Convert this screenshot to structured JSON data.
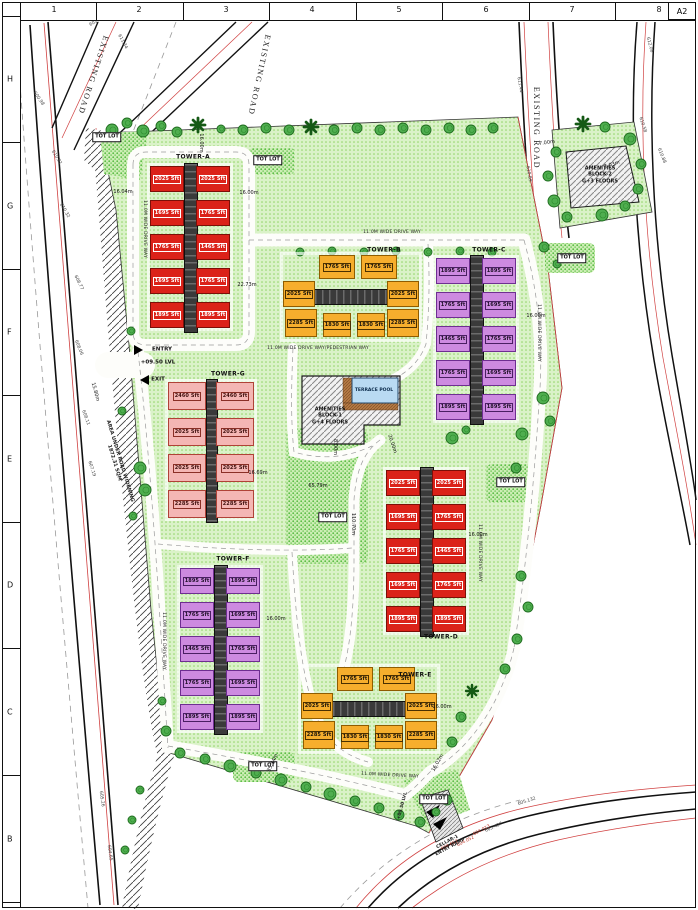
{
  "frame": {
    "sheet": "A2",
    "top_numbers": [
      {
        "t": "1",
        "x": 52
      },
      {
        "t": "2",
        "x": 137
      },
      {
        "t": "3",
        "x": 224
      },
      {
        "t": "4",
        "x": 310
      },
      {
        "t": "5",
        "x": 397
      },
      {
        "t": "6",
        "x": 484
      },
      {
        "t": "7",
        "x": 570
      },
      {
        "t": "8",
        "x": 657
      }
    ],
    "left_letters": [
      {
        "t": "H",
        "y": 77
      },
      {
        "t": "G",
        "y": 204
      },
      {
        "t": "F",
        "y": 330
      },
      {
        "t": "E",
        "y": 457
      },
      {
        "t": "D",
        "y": 583
      },
      {
        "t": "C",
        "y": 710
      },
      {
        "t": "B",
        "y": 837
      }
    ],
    "top_ticks": [
      8,
      94,
      181,
      267,
      354,
      440,
      527,
      613,
      668
    ],
    "left_ticks": [
      14,
      140,
      267,
      393,
      520,
      646,
      773,
      900
    ]
  },
  "palette": {
    "red": {
      "bg": "#db2219",
      "bd": "#7c0f08",
      "tx": "#ffffff",
      "lb": "#ffffff"
    },
    "orange": {
      "bg": "#f6ae2d",
      "bd": "#8f5c00",
      "tx": "#18120a",
      "lb": "#4a3000"
    },
    "purple": {
      "bg": "#cd8ae0",
      "bd": "#6e2e91",
      "tx": "#1d1026",
      "lb": "#4a1f63"
    },
    "pink": {
      "bg": "#f4b6b4",
      "bd": "#b04237",
      "tx": "#3d0f0c",
      "lb": "#8a2f26"
    },
    "lawn": "#daf2c8",
    "lawn_dot": "#8fd465",
    "dense": "#cdeeb5",
    "dense_dot": "#57bb42",
    "pool": "#b9daf2",
    "deck": "#b57a45",
    "road_red": "#d04040",
    "core": "#3a3a3a"
  },
  "towers": [
    {
      "name": "TOWER-A",
      "nx": 193,
      "ny": 157,
      "color": "red",
      "x": 150,
      "y": 166,
      "w": 80,
      "h": 162,
      "uw": 34,
      "uh": 26,
      "core": {
        "x": 34,
        "y": -3,
        "w": 12,
        "h": 168,
        "dir": "v"
      },
      "units": [
        {
          "x": 0,
          "y": 0,
          "t": "2025 Sft"
        },
        {
          "x": 46,
          "y": 0,
          "t": "2025 Sft"
        },
        {
          "x": 0,
          "y": 34,
          "t": "1695 Sft"
        },
        {
          "x": 46,
          "y": 34,
          "t": "1765 Sft"
        },
        {
          "x": 0,
          "y": 68,
          "t": "1765 Sft"
        },
        {
          "x": 46,
          "y": 68,
          "t": "1465 Sft"
        },
        {
          "x": 0,
          "y": 102,
          "t": "1695 Sft"
        },
        {
          "x": 46,
          "y": 102,
          "t": "1765 Sft"
        },
        {
          "x": 0,
          "y": 136,
          "t": "1895 Sft"
        },
        {
          "x": 46,
          "y": 136,
          "t": "1895 Sft"
        }
      ]
    },
    {
      "name": "TOWER-B",
      "nx": 384,
      "ny": 250,
      "color": "orange",
      "x": 283,
      "y": 255,
      "w": 136,
      "h": 84,
      "core": {
        "x": 10,
        "y": 34,
        "w": 118,
        "h": 14,
        "dir": "h"
      },
      "units": [
        {
          "x": 36,
          "y": 0,
          "w": 36,
          "h": 24,
          "t": "1765 Sft"
        },
        {
          "x": 78,
          "y": 0,
          "w": 36,
          "h": 24,
          "t": "1765 Sft"
        },
        {
          "x": 0,
          "y": 26,
          "w": 32,
          "h": 26,
          "t": "2025 Sft"
        },
        {
          "x": 104,
          "y": 26,
          "w": 32,
          "h": 26,
          "t": "2025 Sft"
        },
        {
          "x": 2,
          "y": 54,
          "w": 32,
          "h": 28,
          "t": "2285 Sft"
        },
        {
          "x": 40,
          "y": 58,
          "w": 28,
          "h": 24,
          "t": "1830 Sft"
        },
        {
          "x": 74,
          "y": 58,
          "w": 28,
          "h": 24,
          "t": "1830 Sft"
        },
        {
          "x": 104,
          "y": 54,
          "w": 32,
          "h": 28,
          "t": "2285 Sft"
        }
      ]
    },
    {
      "name": "TOWER-C",
      "nx": 489,
      "ny": 250,
      "color": "purple",
      "x": 436,
      "y": 258,
      "w": 80,
      "h": 162,
      "uw": 34,
      "uh": 26,
      "core": {
        "x": 34,
        "y": -3,
        "w": 12,
        "h": 168,
        "dir": "v"
      },
      "units": [
        {
          "x": 0,
          "y": 0,
          "t": "1895 Sft"
        },
        {
          "x": 46,
          "y": 0,
          "t": "1895 Sft"
        },
        {
          "x": 0,
          "y": 34,
          "t": "1765 Sft"
        },
        {
          "x": 46,
          "y": 34,
          "t": "1695 Sft"
        },
        {
          "x": 0,
          "y": 68,
          "t": "1465 Sft"
        },
        {
          "x": 46,
          "y": 68,
          "t": "1765 Sft"
        },
        {
          "x": 0,
          "y": 102,
          "t": "1765 Sft"
        },
        {
          "x": 46,
          "y": 102,
          "t": "1695 Sft"
        },
        {
          "x": 0,
          "y": 136,
          "t": "1895 Sft"
        },
        {
          "x": 46,
          "y": 136,
          "t": "1895 Sft"
        }
      ]
    },
    {
      "name": "TOWER-G",
      "nx": 228,
      "ny": 374,
      "color": "pink",
      "x": 168,
      "y": 382,
      "w": 86,
      "h": 136,
      "uw": 38,
      "uh": 28,
      "core": {
        "x": 38,
        "y": -3,
        "w": 10,
        "h": 142,
        "dir": "v"
      },
      "units": [
        {
          "x": 0,
          "y": 0,
          "t": "2460 Sft"
        },
        {
          "x": 48,
          "y": 0,
          "t": "2460 Sft"
        },
        {
          "x": 0,
          "y": 36,
          "t": "2025 Sft"
        },
        {
          "x": 48,
          "y": 36,
          "t": "2025 Sft"
        },
        {
          "x": 0,
          "y": 72,
          "t": "2025 Sft"
        },
        {
          "x": 48,
          "y": 72,
          "t": "2025 Sft"
        },
        {
          "x": 0,
          "y": 108,
          "t": "2285 Sft"
        },
        {
          "x": 48,
          "y": 108,
          "t": "2285 Sft"
        }
      ]
    },
    {
      "name": "TOWER-D",
      "nx": 441,
      "ny": 637,
      "color": "red",
      "x": 386,
      "y": 470,
      "w": 80,
      "h": 162,
      "uw": 34,
      "uh": 26,
      "core": {
        "x": 34,
        "y": -3,
        "w": 12,
        "h": 168,
        "dir": "v"
      },
      "units": [
        {
          "x": 0,
          "y": 0,
          "t": "2025 Sft"
        },
        {
          "x": 46,
          "y": 0,
          "t": "2025 Sft"
        },
        {
          "x": 0,
          "y": 34,
          "t": "1695 Sft"
        },
        {
          "x": 46,
          "y": 34,
          "t": "1765 Sft"
        },
        {
          "x": 0,
          "y": 68,
          "t": "1765 Sft"
        },
        {
          "x": 46,
          "y": 68,
          "t": "1465 Sft"
        },
        {
          "x": 0,
          "y": 102,
          "t": "1695 Sft"
        },
        {
          "x": 46,
          "y": 102,
          "t": "1765 Sft"
        },
        {
          "x": 0,
          "y": 136,
          "t": "1895 Sft"
        },
        {
          "x": 46,
          "y": 136,
          "t": "1895 Sft"
        }
      ]
    },
    {
      "name": "TOWER-F",
      "nx": 233,
      "ny": 559,
      "color": "purple",
      "x": 180,
      "y": 568,
      "w": 80,
      "h": 162,
      "uw": 34,
      "uh": 26,
      "core": {
        "x": 34,
        "y": -3,
        "w": 12,
        "h": 168,
        "dir": "v"
      },
      "units": [
        {
          "x": 0,
          "y": 0,
          "t": "1895 Sft"
        },
        {
          "x": 46,
          "y": 0,
          "t": "1895 Sft"
        },
        {
          "x": 0,
          "y": 34,
          "t": "1765 Sft"
        },
        {
          "x": 46,
          "y": 34,
          "t": "1695 Sft"
        },
        {
          "x": 0,
          "y": 68,
          "t": "1465 Sft"
        },
        {
          "x": 46,
          "y": 68,
          "t": "1765 Sft"
        },
        {
          "x": 0,
          "y": 102,
          "t": "1765 Sft"
        },
        {
          "x": 46,
          "y": 102,
          "t": "1695 Sft"
        },
        {
          "x": 0,
          "y": 136,
          "t": "1895 Sft"
        },
        {
          "x": 46,
          "y": 136,
          "t": "1895 Sft"
        }
      ]
    },
    {
      "name": "TOWER-E",
      "nx": 415,
      "ny": 675,
      "color": "orange",
      "x": 301,
      "y": 667,
      "w": 136,
      "h": 84,
      "core": {
        "x": 10,
        "y": 34,
        "w": 118,
        "h": 14,
        "dir": "h"
      },
      "units": [
        {
          "x": 36,
          "y": 0,
          "w": 36,
          "h": 24,
          "t": "1765 Sft"
        },
        {
          "x": 78,
          "y": 0,
          "w": 36,
          "h": 24,
          "t": "1765 Sft"
        },
        {
          "x": 0,
          "y": 26,
          "w": 32,
          "h": 26,
          "t": "2025 Sft"
        },
        {
          "x": 104,
          "y": 26,
          "w": 32,
          "h": 26,
          "t": "2025 Sft"
        },
        {
          "x": 2,
          "y": 54,
          "w": 32,
          "h": 28,
          "t": "2285 Sft"
        },
        {
          "x": 40,
          "y": 58,
          "w": 28,
          "h": 24,
          "t": "1830 Sft"
        },
        {
          "x": 74,
          "y": 58,
          "w": 28,
          "h": 24,
          "t": "1830 Sft"
        },
        {
          "x": 104,
          "y": 54,
          "w": 32,
          "h": 28,
          "t": "2285 Sft"
        }
      ]
    }
  ],
  "tot_lot_label": "TOT LOT",
  "tot_lots": [
    [
      107,
      137
    ],
    [
      268,
      160
    ],
    [
      572,
      258
    ],
    [
      511,
      482
    ],
    [
      333,
      517
    ],
    [
      263,
      766
    ],
    [
      434,
      799
    ]
  ],
  "existing_road_label": "EXISTING ROAD",
  "road_labels": [
    [
      93,
      75,
      108
    ],
    [
      259,
      75,
      102
    ],
    [
      536,
      128,
      90
    ]
  ],
  "drive_labels": [
    [
      "11.0M WIDE DRIVE WAY",
      392,
      233,
      0
    ],
    [
      "11.0M WIDE DRIVE WAY/PEDESTRIAN WAY",
      318,
      349,
      0
    ],
    [
      "11.0M WIDE DRIVE WAY",
      538,
      333,
      90
    ],
    [
      "11.0M WIDE DRIVE WAY",
      479,
      553,
      90
    ],
    [
      "11.0M WIDE DRIVE WAY",
      163,
      641,
      90
    ],
    [
      "11.0M WIDE DRIVE WAY",
      144,
      229,
      90
    ],
    [
      "11.0M WIDE DRIVE WAY",
      390,
      776,
      3
    ]
  ],
  "dimensions": [
    [
      "16.00m",
      249,
      193,
      0
    ],
    [
      "16.04m",
      123,
      192,
      0
    ],
    [
      "22.73m",
      247,
      285,
      0
    ],
    [
      "16.00m",
      536,
      316,
      0
    ],
    [
      "16.69m",
      258,
      473,
      0
    ],
    [
      "16.00m",
      478,
      535,
      0
    ],
    [
      "16.00m",
      276,
      619,
      0
    ],
    [
      "16.00m",
      442,
      707,
      0
    ],
    [
      "65.79m",
      318,
      486,
      0
    ],
    [
      "110.70m",
      353,
      524,
      90
    ],
    [
      "8.00m",
      335,
      447,
      90
    ],
    [
      "20.00m",
      392,
      444,
      72
    ],
    [
      "16.00m",
      201,
      143,
      90
    ],
    [
      "7.00m",
      547,
      143,
      -8
    ],
    [
      "7.03m",
      612,
      165,
      -18
    ],
    [
      "15.80m",
      95,
      392,
      75
    ],
    [
      "35.34m",
      273,
      763,
      -65
    ],
    [
      "16.02m",
      438,
      763,
      -60
    ]
  ],
  "survey_marks": [
    [
      "601.27",
      97,
      22,
      -30,
      0
    ],
    [
      "607.86",
      118,
      14,
      -30,
      0
    ],
    [
      "611.34",
      122,
      42,
      62,
      0
    ],
    [
      "600.98",
      38,
      99,
      55,
      0
    ],
    [
      "610.81",
      56,
      158,
      58,
      0
    ],
    [
      "610.32",
      64,
      211,
      60,
      0
    ],
    [
      "608.77",
      78,
      283,
      64,
      0
    ],
    [
      "608.06",
      78,
      348,
      68,
      0
    ],
    [
      "608.11",
      85,
      418,
      70,
      0
    ],
    [
      "607.19",
      91,
      469,
      72,
      0
    ],
    [
      "611.44",
      519,
      85,
      80,
      0
    ],
    [
      "610.89",
      528,
      174,
      80,
      0
    ],
    [
      "612.06",
      649,
      45,
      75,
      0
    ],
    [
      "610.58",
      642,
      125,
      72,
      0
    ],
    [
      "610.88",
      661,
      156,
      68,
      0
    ],
    [
      "605.132",
      527,
      802,
      -18,
      0
    ],
    [
      "605.427",
      494,
      828,
      -24,
      0
    ],
    [
      "605.26",
      101,
      799,
      82,
      0
    ],
    [
      "604.65",
      109,
      853,
      82,
      0
    ],
    [
      "604.013",
      482,
      831,
      -28,
      1
    ],
    [
      "604.652",
      450,
      846,
      -27,
      1
    ],
    [
      "604.052",
      466,
      842,
      -27,
      1
    ]
  ],
  "annotations": [
    [
      "ENTRY",
      162,
      350,
      0,
      "lvl"
    ],
    [
      "+09.50 LVL",
      158,
      363,
      0,
      "lvl"
    ],
    [
      "EXIT",
      158,
      380,
      0,
      "lvl"
    ],
    [
      "AREA UNDER ROAD WIDENING\n1872.31 SQM",
      117,
      462,
      73,
      "note"
    ],
    [
      "AMENITIES\nBLOCK-1\nG+4 FLOORS",
      330,
      416,
      0,
      "amen"
    ],
    [
      "TERRACE POOL",
      374,
      391,
      0,
      "pool"
    ],
    [
      "AMENITIES\nBLOCK-2\nG+3 FLOORS",
      600,
      175,
      0,
      "amen"
    ],
    [
      "CELLAR-1\nENTRY RAMP",
      449,
      845,
      -28,
      "ramp"
    ],
    [
      "+09.50 LVL",
      403,
      806,
      -75,
      "ramp"
    ]
  ],
  "arrows": [
    [
      141,
      350,
      "right"
    ],
    [
      142,
      380,
      "left"
    ]
  ],
  "trees": [
    [
      112,
      130,
      6,
      "t"
    ],
    [
      127,
      123,
      5,
      "t"
    ],
    [
      143,
      131,
      6,
      "t"
    ],
    [
      161,
      126,
      5,
      "t"
    ],
    [
      177,
      132,
      5,
      "t"
    ],
    [
      198,
      125,
      7,
      "p"
    ],
    [
      221,
      129,
      4,
      "t"
    ],
    [
      243,
      130,
      5,
      "t"
    ],
    [
      266,
      128,
      5,
      "t"
    ],
    [
      289,
      130,
      5,
      "t"
    ],
    [
      311,
      127,
      7,
      "p"
    ],
    [
      334,
      130,
      5,
      "t"
    ],
    [
      357,
      128,
      5,
      "t"
    ],
    [
      380,
      130,
      5,
      "t"
    ],
    [
      403,
      128,
      5,
      "t"
    ],
    [
      426,
      130,
      5,
      "t"
    ],
    [
      449,
      128,
      5,
      "t"
    ],
    [
      471,
      130,
      5,
      "t"
    ],
    [
      493,
      128,
      5,
      "t"
    ],
    [
      300,
      252,
      4,
      "t"
    ],
    [
      332,
      251,
      4,
      "t"
    ],
    [
      364,
      252,
      4,
      "t"
    ],
    [
      396,
      251,
      4,
      "t"
    ],
    [
      428,
      252,
      4,
      "t"
    ],
    [
      460,
      251,
      4,
      "t"
    ],
    [
      492,
      252,
      4,
      "t"
    ],
    [
      583,
      124,
      7,
      "p"
    ],
    [
      556,
      152,
      5,
      "t"
    ],
    [
      548,
      176,
      5,
      "t"
    ],
    [
      554,
      201,
      6,
      "t"
    ],
    [
      567,
      217,
      5,
      "t"
    ],
    [
      602,
      215,
      6,
      "t"
    ],
    [
      625,
      206,
      5,
      "t"
    ],
    [
      638,
      189,
      5,
      "t"
    ],
    [
      641,
      164,
      5,
      "t"
    ],
    [
      630,
      139,
      6,
      "t"
    ],
    [
      605,
      127,
      5,
      "t"
    ],
    [
      544,
      247,
      5,
      "t"
    ],
    [
      557,
      264,
      4,
      "t"
    ],
    [
      543,
      398,
      6,
      "t"
    ],
    [
      550,
      421,
      5,
      "t"
    ],
    [
      522,
      434,
      6,
      "t"
    ],
    [
      516,
      468,
      5,
      "t"
    ],
    [
      452,
      438,
      6,
      "t"
    ],
    [
      466,
      430,
      4,
      "t"
    ],
    [
      467,
      371,
      6,
      "p"
    ],
    [
      521,
      576,
      5,
      "t"
    ],
    [
      528,
      607,
      5,
      "t"
    ],
    [
      517,
      639,
      5,
      "t"
    ],
    [
      505,
      669,
      5,
      "t"
    ],
    [
      472,
      691,
      6,
      "p"
    ],
    [
      461,
      717,
      5,
      "t"
    ],
    [
      452,
      742,
      5,
      "t"
    ],
    [
      180,
      753,
      5,
      "t"
    ],
    [
      205,
      759,
      5,
      "t"
    ],
    [
      230,
      766,
      6,
      "t"
    ],
    [
      256,
      773,
      5,
      "t"
    ],
    [
      281,
      780,
      6,
      "t"
    ],
    [
      306,
      787,
      5,
      "t"
    ],
    [
      330,
      794,
      6,
      "t"
    ],
    [
      355,
      801,
      5,
      "t"
    ],
    [
      379,
      808,
      5,
      "t"
    ],
    [
      399,
      815,
      5,
      "t"
    ],
    [
      420,
      822,
      5,
      "t"
    ],
    [
      436,
      812,
      4,
      "t"
    ],
    [
      447,
      800,
      5,
      "t"
    ],
    [
      140,
      468,
      6,
      "t"
    ],
    [
      145,
      490,
      6,
      "t"
    ],
    [
      133,
      516,
      4,
      "t"
    ],
    [
      122,
      411,
      4,
      "t"
    ],
    [
      131,
      331,
      4,
      "t"
    ],
    [
      166,
      731,
      5,
      "t"
    ],
    [
      162,
      701,
      4,
      "t"
    ],
    [
      140,
      790,
      4,
      "t"
    ],
    [
      132,
      820,
      4,
      "t"
    ],
    [
      125,
      850,
      4,
      "t"
    ]
  ]
}
